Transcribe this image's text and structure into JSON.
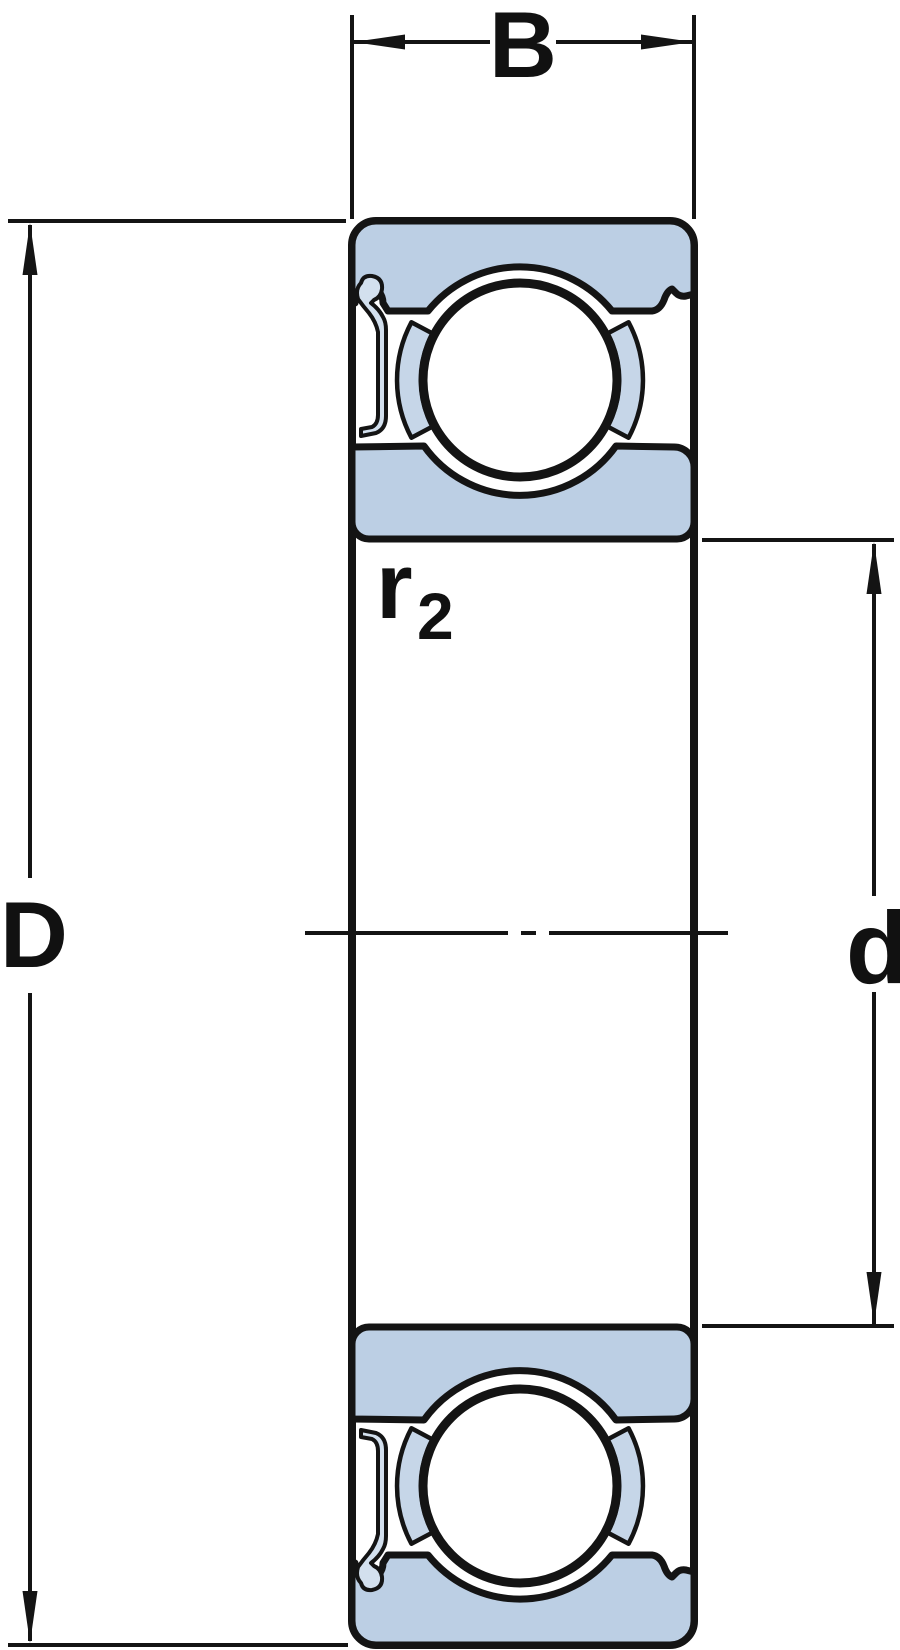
{
  "diagram": {
    "type": "bearing-cross-section",
    "labels": {
      "width": "B",
      "outer_diameter": "D",
      "bore_diameter": "d",
      "fillet_radius_base": "r",
      "fillet_radius_subscript": "2"
    },
    "colors": {
      "ring_fill": "#bccfe4",
      "cage_fill": "#c6d6e8",
      "shield_fill": "#d3e0ee",
      "line_color": "#141414",
      "label_color": "#111111",
      "background": "#ffffff"
    }
  }
}
